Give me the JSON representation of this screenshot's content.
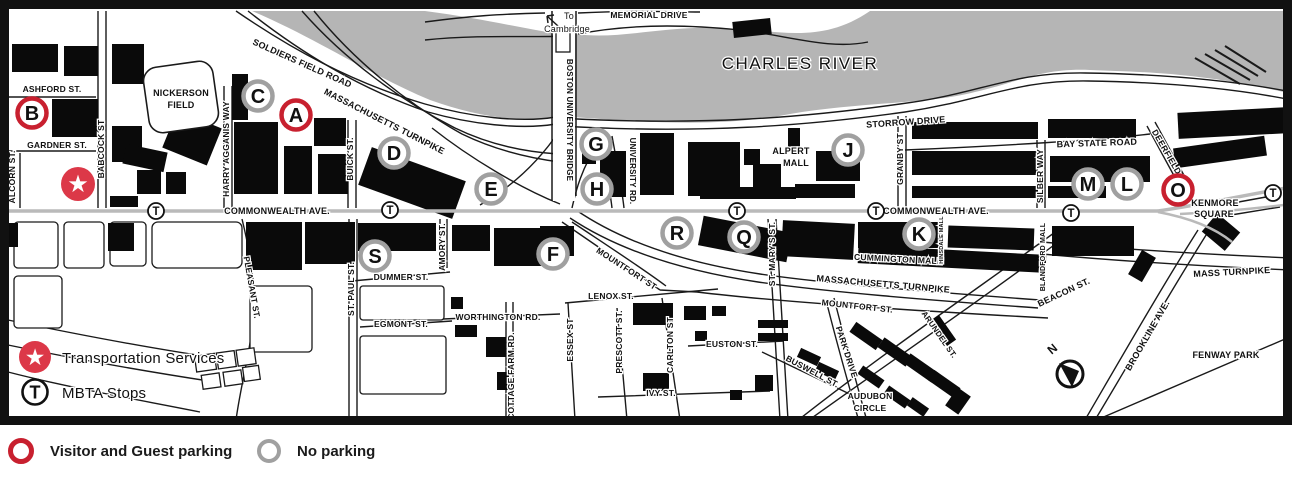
{
  "title": "Boston University campus parking map",
  "colors": {
    "visitor_red": "#c8202f",
    "star_red": "#dc3848",
    "no_parking_gray": "#a0a0a0",
    "river_gray": "#b5b5b5",
    "road_gray": "#bababa",
    "building_black": "#0a0a0a"
  },
  "legend": {
    "visitor_label": "Visitor and Guest parking",
    "no_parking_label": "No parking",
    "transportation_label": "Transportation Services",
    "mbta_label": "MBTA Stops"
  },
  "map": {
    "markers": [
      {
        "letter": "A",
        "x": 296,
        "y": 115,
        "type": "visitor"
      },
      {
        "letter": "B",
        "x": 32,
        "y": 113,
        "type": "visitor"
      },
      {
        "letter": "C",
        "x": 258,
        "y": 96,
        "type": "none"
      },
      {
        "letter": "D",
        "x": 394,
        "y": 153,
        "type": "none"
      },
      {
        "letter": "E",
        "x": 491,
        "y": 189,
        "type": "none"
      },
      {
        "letter": "F",
        "x": 553,
        "y": 254,
        "type": "none"
      },
      {
        "letter": "G",
        "x": 596,
        "y": 144,
        "type": "none"
      },
      {
        "letter": "H",
        "x": 597,
        "y": 189,
        "type": "none"
      },
      {
        "letter": "J",
        "x": 848,
        "y": 150,
        "type": "none"
      },
      {
        "letter": "K",
        "x": 919,
        "y": 234,
        "type": "none"
      },
      {
        "letter": "L",
        "x": 1127,
        "y": 184,
        "type": "none"
      },
      {
        "letter": "M",
        "x": 1088,
        "y": 184,
        "type": "none"
      },
      {
        "letter": "O",
        "x": 1178,
        "y": 190,
        "type": "visitor"
      },
      {
        "letter": "Q",
        "x": 744,
        "y": 237,
        "type": "none"
      },
      {
        "letter": "R",
        "x": 677,
        "y": 233,
        "type": "none"
      },
      {
        "letter": "S",
        "x": 375,
        "y": 256,
        "type": "none"
      }
    ],
    "t_stops": [
      {
        "x": 156,
        "y": 211
      },
      {
        "x": 390,
        "y": 210
      },
      {
        "x": 737,
        "y": 211
      },
      {
        "x": 876,
        "y": 211
      },
      {
        "x": 1071,
        "y": 213
      },
      {
        "x": 1273,
        "y": 193
      }
    ],
    "transportation_star": {
      "x": 78,
      "y": 184
    },
    "inmap_legend": {
      "star": {
        "x": 35,
        "y": 357
      },
      "t": {
        "x": 35,
        "y": 392
      }
    },
    "compass": {
      "label": "N"
    },
    "labels": [
      {
        "t": "SOLDIERS FIELD ROAD",
        "x": 301,
        "y": 66,
        "r": 24,
        "s": 9
      },
      {
        "t": "MASSACHUSETTS TURNPIKE",
        "x": 383,
        "y": 124,
        "r": 27,
        "s": 9
      },
      {
        "t": "To",
        "x": 569,
        "y": 19,
        "s": 9,
        "w": 400
      },
      {
        "t": "Cambridge",
        "x": 567,
        "y": 32,
        "s": 9,
        "w": 400
      },
      {
        "t": "MEMORIAL DRIVE",
        "x": 649,
        "y": 18,
        "s": 8.5
      },
      {
        "t": "CHARLES RIVER",
        "x": 800,
        "y": 69,
        "s": 17,
        "w": 400,
        "ls": 1.5
      },
      {
        "t": "BOSTON UNIVERSITY BRIDGE",
        "x": 567,
        "y": 120,
        "r": 90,
        "s": 8
      },
      {
        "t": "STORROW DRIVE",
        "x": 906,
        "y": 125,
        "r": -4,
        "s": 9
      },
      {
        "t": "BAY STATE ROAD",
        "x": 1097,
        "y": 146,
        "r": -2,
        "s": 9
      },
      {
        "t": "GRANBY ST",
        "x": 903,
        "y": 159,
        "r": -90,
        "s": 8.5
      },
      {
        "t": "SILBER WAY",
        "x": 1043,
        "y": 176,
        "r": -90,
        "s": 8.5
      },
      {
        "t": "DEERFIELD ST.",
        "x": 1168,
        "y": 160,
        "r": 60,
        "s": 8.5
      },
      {
        "t": "KENMORE",
        "x": 1215,
        "y": 206,
        "s": 9
      },
      {
        "t": "SQUARE",
        "x": 1214,
        "y": 217,
        "s": 9
      },
      {
        "t": "COMMONWEALTH AVE.",
        "x": 277,
        "y": 214,
        "s": 9
      },
      {
        "t": "COMMONWEALTH AVE.",
        "x": 936,
        "y": 214,
        "s": 9
      },
      {
        "t": "ASHFORD ST.",
        "x": 52,
        "y": 92,
        "s": 8.5
      },
      {
        "t": "GARDNER ST.",
        "x": 57,
        "y": 148,
        "s": 8.5
      },
      {
        "t": "ALCORN ST.",
        "x": 15,
        "y": 177,
        "r": -90,
        "s": 8.5
      },
      {
        "t": "BABCOCK ST",
        "x": 104,
        "y": 149,
        "r": -90,
        "s": 8.5
      },
      {
        "t": "NICKERSON",
        "x": 181,
        "y": 96,
        "s": 9
      },
      {
        "t": "FIELD",
        "x": 181,
        "y": 108,
        "s": 9
      },
      {
        "t": "HARRY AGGANIS WAY",
        "x": 229,
        "y": 149,
        "r": -90,
        "s": 8.5
      },
      {
        "t": "BUICK ST.",
        "x": 353,
        "y": 159,
        "r": -90,
        "s": 8.5
      },
      {
        "t": "UNIVERSITY RD.",
        "x": 630,
        "y": 171,
        "r": 90,
        "s": 8
      },
      {
        "t": "ALPERT",
        "x": 791,
        "y": 154,
        "s": 9
      },
      {
        "t": "MALL",
        "x": 796,
        "y": 166,
        "s": 9
      },
      {
        "t": "PLEASANT ST.",
        "x": 249,
        "y": 288,
        "r": 80,
        "s": 8.5
      },
      {
        "t": "ST. PAUL ST.",
        "x": 354,
        "y": 289,
        "r": -90,
        "s": 8.5
      },
      {
        "t": "DUMMER ST.",
        "x": 401,
        "y": 280,
        "s": 8.5
      },
      {
        "t": "EGMONT ST.",
        "x": 401,
        "y": 327,
        "s": 8.5
      },
      {
        "t": "AMORY ST.",
        "x": 445,
        "y": 247,
        "r": -90,
        "s": 8.5
      },
      {
        "t": "WORTHINGTON RD.",
        "x": 498,
        "y": 320,
        "s": 8.5
      },
      {
        "t": "COTTAGE FARM RD.",
        "x": 514,
        "y": 376,
        "r": -90,
        "s": 8.5
      },
      {
        "t": "ESSEX ST",
        "x": 573,
        "y": 340,
        "r": -90,
        "s": 8.5
      },
      {
        "t": "PRESCOTT ST.",
        "x": 622,
        "y": 342,
        "r": -90,
        "s": 8.5
      },
      {
        "t": "CARLTON ST",
        "x": 673,
        "y": 345,
        "r": -90,
        "s": 8.5
      },
      {
        "t": "LENOX ST.",
        "x": 611,
        "y": 299,
        "s": 8.5
      },
      {
        "t": "IVY ST.",
        "x": 661,
        "y": 396,
        "s": 8.5
      },
      {
        "t": "EUSTON ST.",
        "x": 732,
        "y": 347,
        "s": 8.5
      },
      {
        "t": "MOUNTFORT ST",
        "x": 625,
        "y": 271,
        "r": 33,
        "s": 8.5
      },
      {
        "t": "MOUNTFORT ST.",
        "x": 857,
        "y": 309,
        "r": 6,
        "s": 8.5
      },
      {
        "t": "ST. MARY'S ST.",
        "x": 775,
        "y": 254,
        "r": -90,
        "s": 8.5
      },
      {
        "t": "BUSWELL ST.",
        "x": 811,
        "y": 374,
        "r": 28,
        "s": 8.5
      },
      {
        "t": "PARK DRIVE",
        "x": 844,
        "y": 353,
        "r": 72,
        "s": 8.5
      },
      {
        "t": "ARUNDEL ST.",
        "x": 937,
        "y": 336,
        "r": 55,
        "s": 8
      },
      {
        "t": "BEACON ST.",
        "x": 1065,
        "y": 295,
        "r": -25,
        "s": 9
      },
      {
        "t": "BROOKLINE AVE.",
        "x": 1150,
        "y": 337,
        "r": -60,
        "s": 9
      },
      {
        "t": "MASSACHUSETTS TURNPIKE",
        "x": 883,
        "y": 287,
        "r": 5,
        "s": 9
      },
      {
        "t": "MASS TURNPIKE",
        "x": 1232,
        "y": 275,
        "r": -3,
        "s": 9
      },
      {
        "t": "CUMMINGTON MALL",
        "x": 898,
        "y": 262,
        "r": 3,
        "s": 8.5
      },
      {
        "t": "HINSDALE MALL",
        "x": 943,
        "y": 240,
        "r": -90,
        "s": 5.5
      },
      {
        "t": "BLANDFORD MALL",
        "x": 1045,
        "y": 257,
        "r": -90,
        "s": 7
      },
      {
        "t": "AUDUBON",
        "x": 870,
        "y": 399,
        "s": 8.5
      },
      {
        "t": "CIRCLE",
        "x": 870,
        "y": 411,
        "s": 8.5
      },
      {
        "t": "FENWAY PARK",
        "x": 1226,
        "y": 358,
        "s": 9
      },
      {
        "t": "N",
        "x": 1055,
        "y": 352,
        "r": -40,
        "s": 12
      },
      {
        "t": "Transportation Services",
        "x": 62,
        "y": 363,
        "s": 15,
        "w": 400,
        "a": "s"
      },
      {
        "t": "MBTA Stops",
        "x": 62,
        "y": 398,
        "s": 15,
        "w": 400,
        "a": "s"
      }
    ]
  }
}
